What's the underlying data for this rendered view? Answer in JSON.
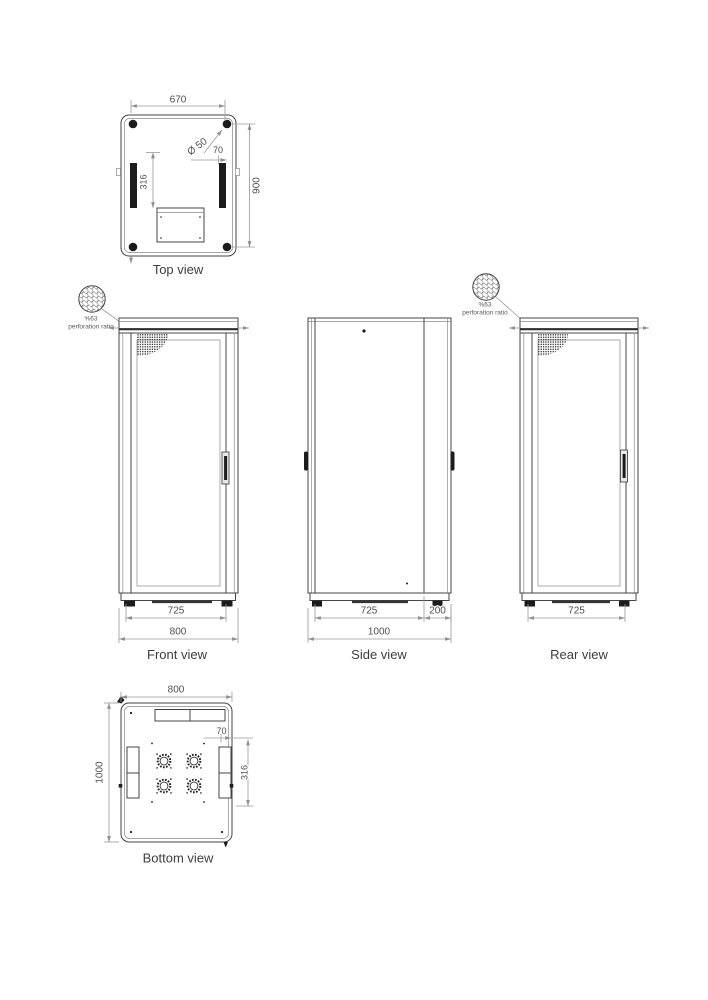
{
  "palette": {
    "line": "#454545",
    "mid": "#8a8a8a",
    "dim": "#9a9a9a",
    "dark": "#1c1c1c",
    "text": "#4f4f4f"
  },
  "icons": {
    "perforation_sample": "perforated-circle-icon",
    "fan": "fan-cutout-icon",
    "corner_hole": "corner-hole-icon"
  },
  "views": {
    "top": {
      "label": "Top view",
      "dim_width": "670",
      "dim_hole": "Ø 50",
      "dim_offset": "70",
      "dim_slot": "316",
      "dim_depth": "900"
    },
    "front": {
      "label": "Front view",
      "dim_inner": "725",
      "dim_outer": "800"
    },
    "side": {
      "label": "Side view",
      "dim_body": "725",
      "dim_rear": "200",
      "dim_total": "1000"
    },
    "rear": {
      "label": "Rear view",
      "dim_inner": "725"
    },
    "bottom": {
      "label": "Bottom view",
      "dim_width": "800",
      "dim_depth": "1000",
      "dim_offset": "70",
      "dim_slot": "316"
    }
  },
  "callouts": {
    "front": {
      "ratio": "%63",
      "caption": "perforation ratio"
    },
    "rear": {
      "ratio": "%63",
      "caption": "perforation ratio"
    }
  }
}
